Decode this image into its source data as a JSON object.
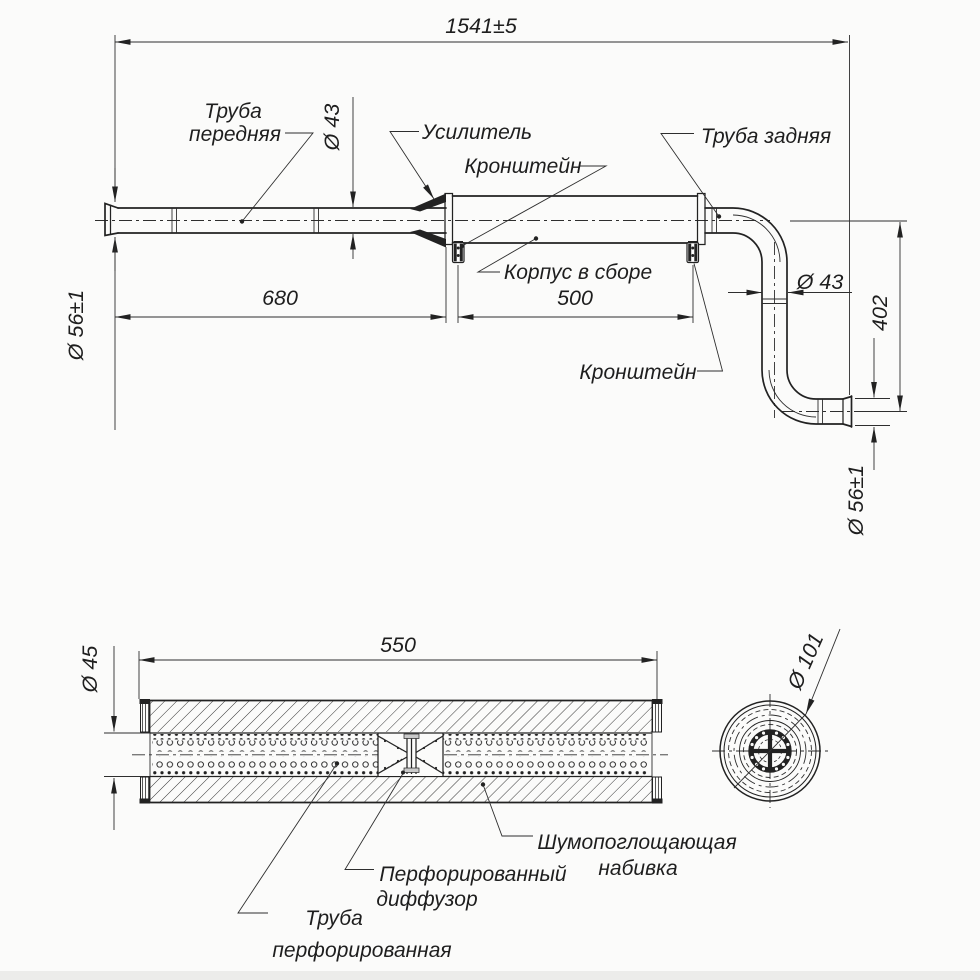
{
  "colors": {
    "background": "#fbfbfa",
    "ink": "#222222"
  },
  "top_view": {
    "dims": {
      "overall": "1541±5",
      "front_pipe_length": "680",
      "body_length": "500",
      "tail_drop": "402",
      "front_pipe_dia": "Ø 43",
      "tail_pipe_dia": "Ø 43",
      "inlet_dia": "Ø 56±1",
      "outlet_dia": "Ø 56±1"
    },
    "labels": {
      "front_pipe_line1": "Труба",
      "front_pipe_line2": "передняя",
      "reinforcement": "Усилитель",
      "bracket_upper": "Кронштейн",
      "bracket_lower": "Кронштейн",
      "rear_pipe": "Труба задняя",
      "body_assembly": "Корпус в сборе"
    }
  },
  "section_view": {
    "dims": {
      "length": "550",
      "pipe_dia": "Ø 45"
    },
    "labels": {
      "padding_line1": "Шумопоглощающая",
      "padding_line2": "набивка",
      "diffuser_line1": "Перфорированный",
      "diffuser_line2": "диффузор",
      "perforated_pipe_line1": "Труба",
      "perforated_pipe_line2": "перфорированная"
    }
  },
  "end_view": {
    "dims": {
      "outer_dia": "Ø 101"
    }
  }
}
